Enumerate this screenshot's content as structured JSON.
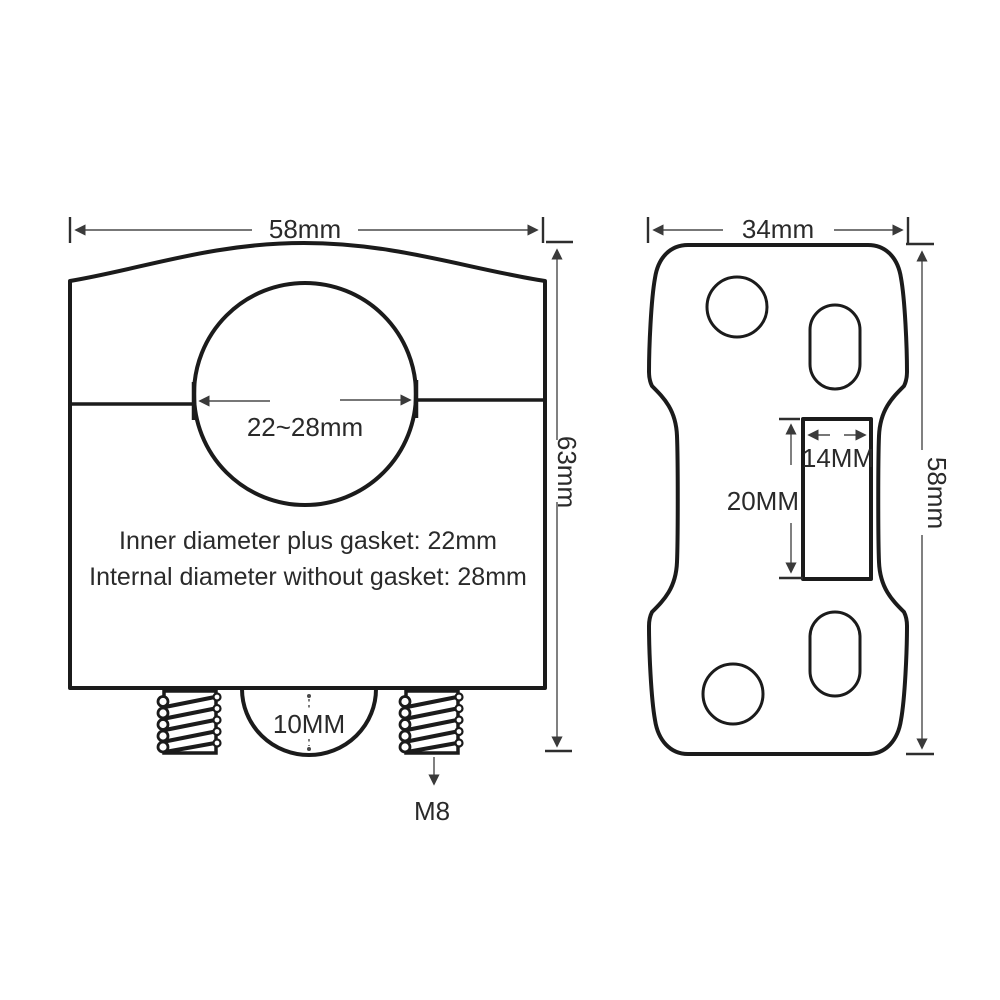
{
  "colors": {
    "background": "#ffffff",
    "outline": "#1b1b1b",
    "dimension_line": "#4a4a4a",
    "text": "#2a2a2a"
  },
  "front_view": {
    "width_dim": "58mm",
    "height_dim": "63mm",
    "bore_dim": "22~28mm",
    "note_line1": "Inner diameter plus gasket: 22mm",
    "note_line2": "Internal diameter without gasket: 28mm",
    "dome_dim": "10MM",
    "thread_label": "M8"
  },
  "side_view": {
    "width_dim": "34mm",
    "height_dim": "58mm",
    "slot_width_dim": "14MM",
    "slot_length_dim": "20MM"
  }
}
